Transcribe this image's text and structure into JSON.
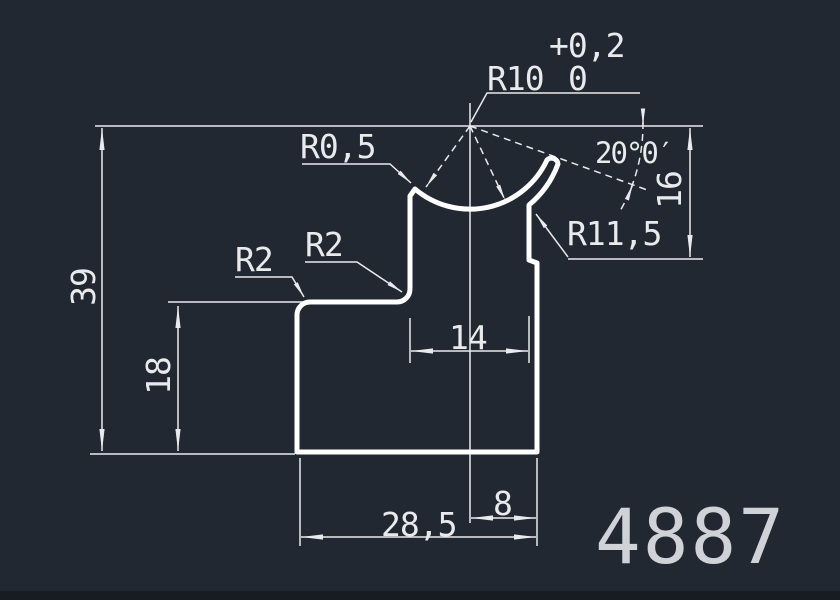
{
  "app": {
    "type": "cad-profile-drawing"
  },
  "colors": {
    "background": "#222831",
    "outline": "#ffffff",
    "dimension_lines": "#e9eaec",
    "text": "#e9eaec",
    "part_number_text": "#cfd3d8"
  },
  "drawing": {
    "part_number": "4887",
    "tolerance": {
      "upper": "+0,2",
      "lower": "0"
    },
    "radius_labels": {
      "r10": "R10",
      "r05": "R0,5",
      "r2_left": "R2",
      "r2_right": "R2",
      "r115": "R11,5"
    },
    "angle_dim": "20°0′",
    "linear_dims": {
      "dim_39": "39",
      "dim_18": "18",
      "dim_16": "16",
      "dim_14": "14",
      "dim_28_5": "28,5",
      "dim_8": "8"
    }
  }
}
